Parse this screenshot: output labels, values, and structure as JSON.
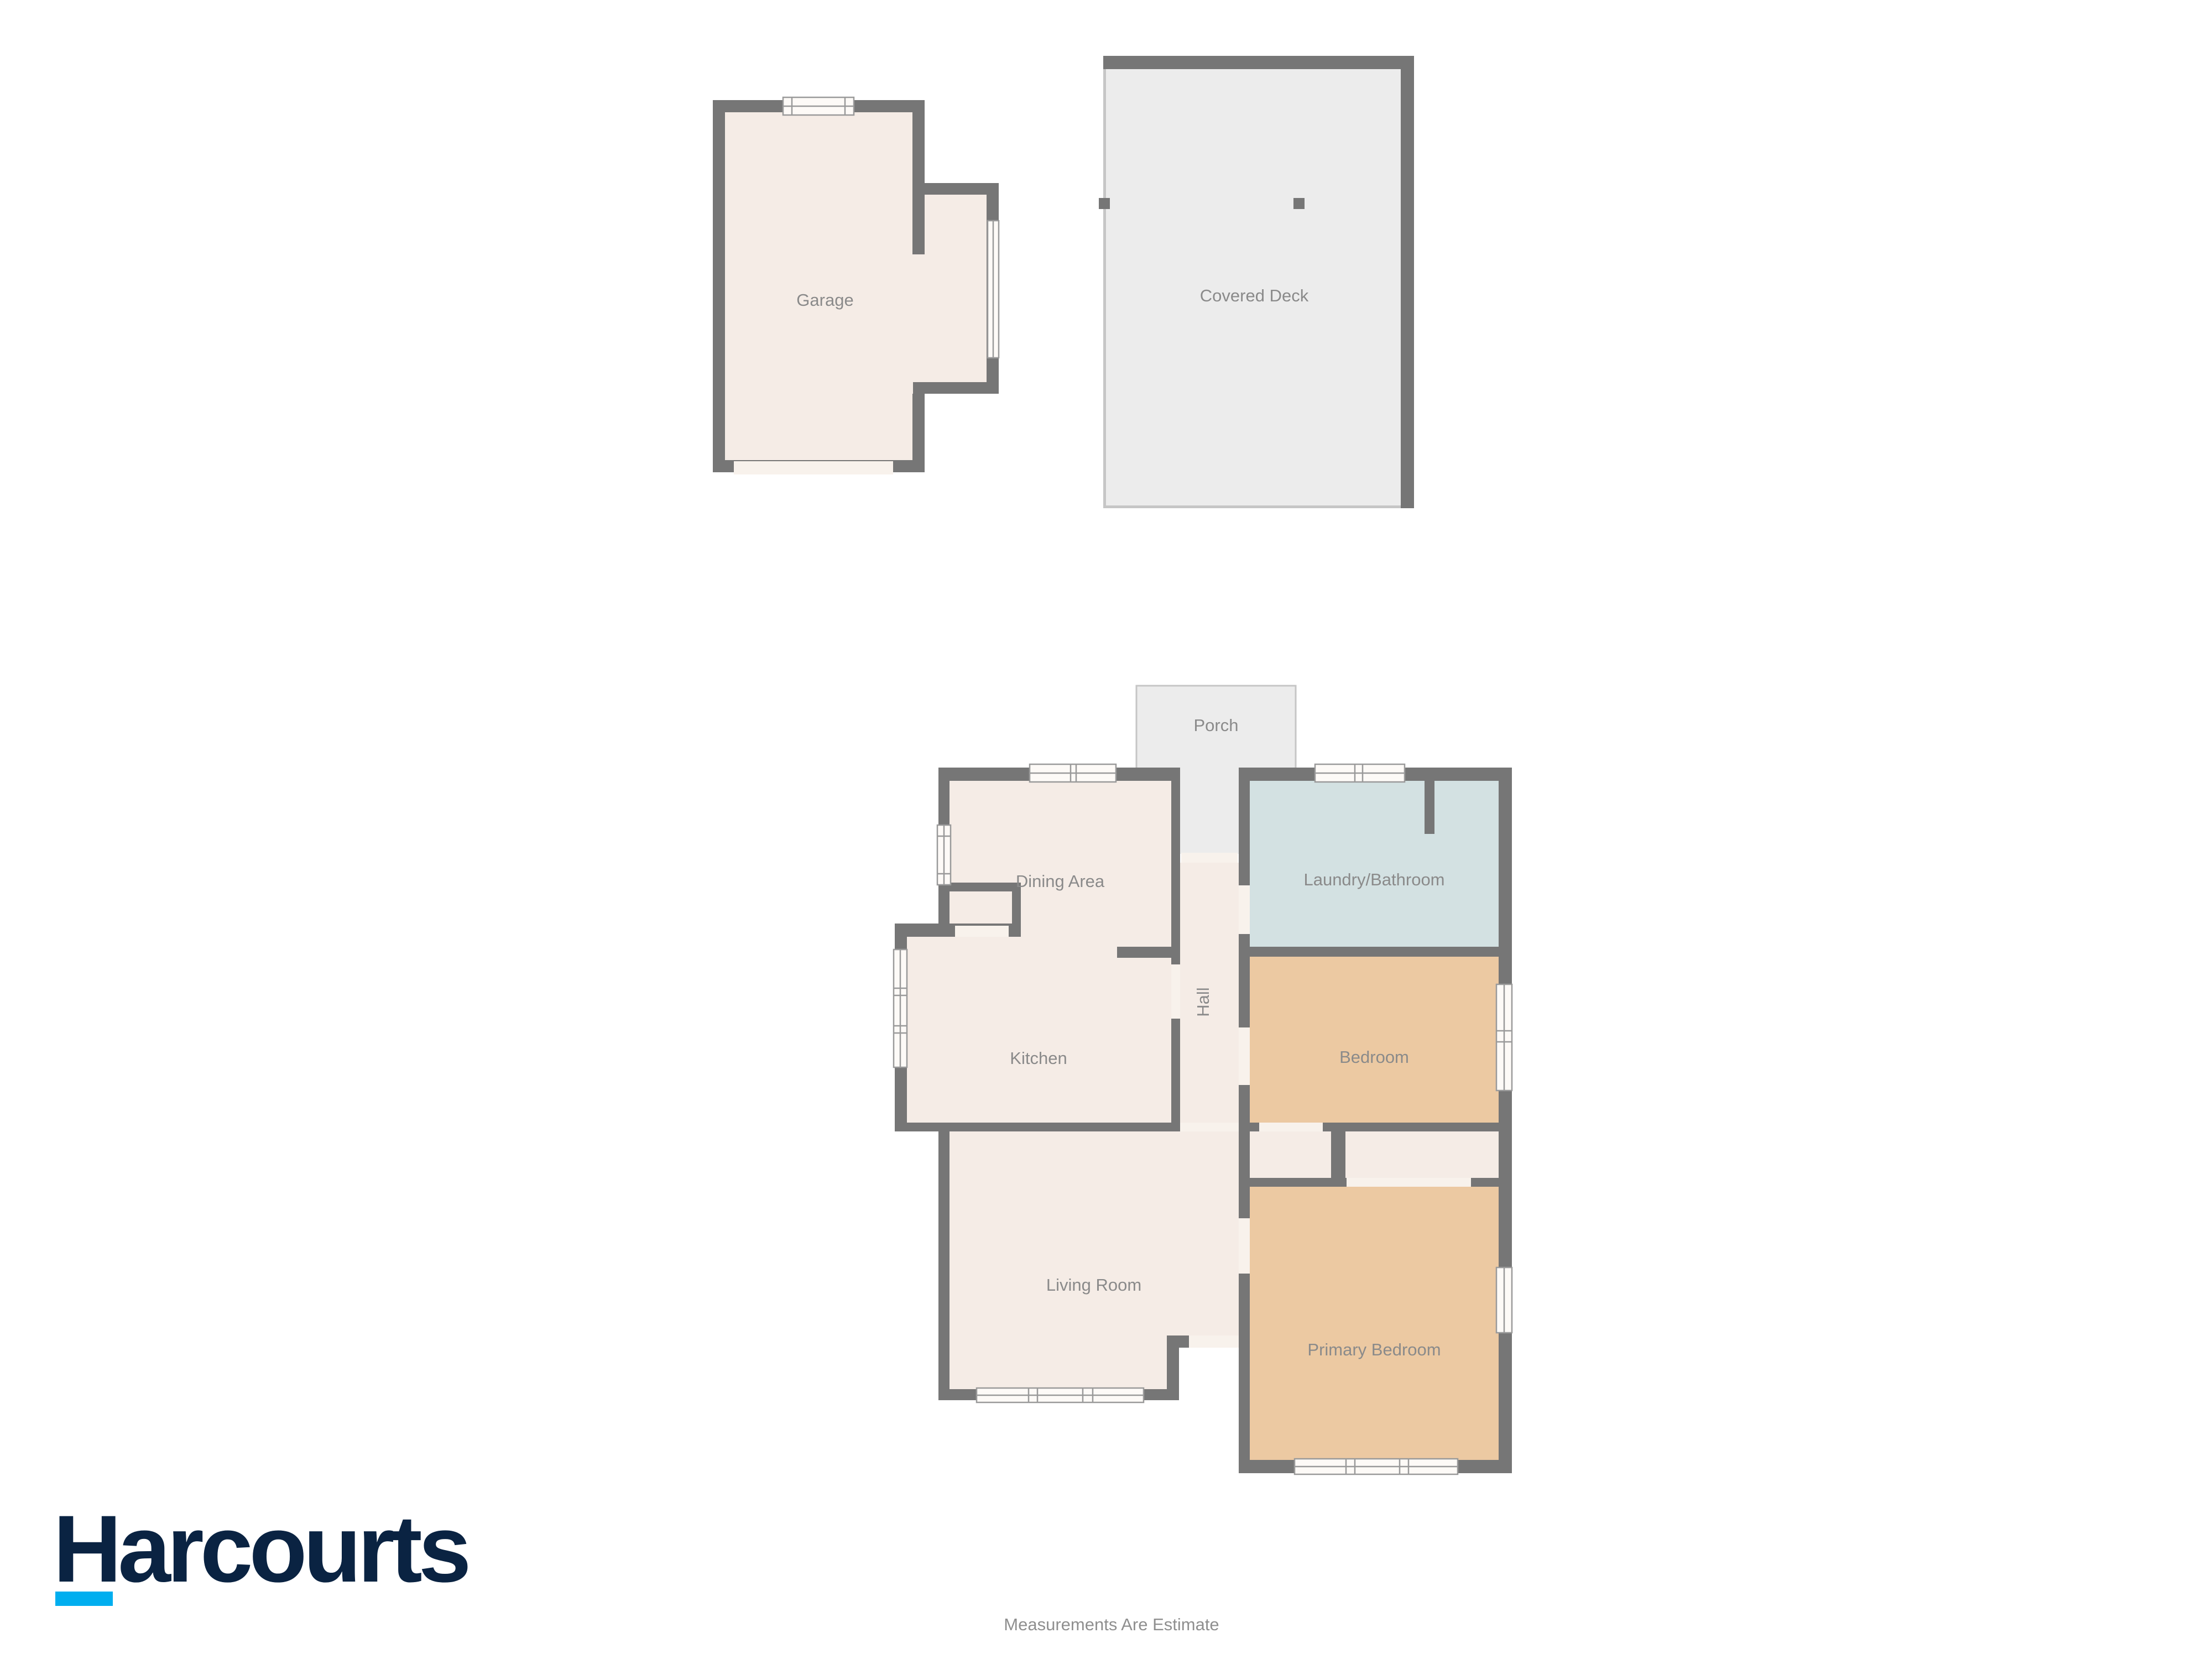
{
  "colors": {
    "wall": "#767676",
    "room_cream": "#f5ece6",
    "room_tan": "#ecc9a2",
    "room_blue": "#d3e1e2",
    "outdoor_gray": "#ececec",
    "outdoor_border": "#c6c6c6",
    "window_fill": "#fdfaf7",
    "window_frame": "#9a9a9a",
    "threshold": "#f8f2ec",
    "label_gray": "#8a8a8a",
    "logo_navy": "#0a2342",
    "logo_cyan": "#00aeef",
    "disclaimer_gray": "#8f8f8f"
  },
  "plan": {
    "garage": {
      "label": "Garage"
    },
    "covered_deck": {
      "label": "Covered Deck"
    },
    "porch": {
      "label": "Porch"
    },
    "dining": {
      "label": "Dining Area"
    },
    "laundry": {
      "label": "Laundry/Bathroom"
    },
    "hall": {
      "label": "Hall"
    },
    "kitchen": {
      "label": "Kitchen"
    },
    "bedroom": {
      "label": "Bedroom"
    },
    "living": {
      "label": "Living Room"
    },
    "primary": {
      "label": "Primary Bedroom"
    }
  },
  "branding": {
    "logo_text": "Harcourts"
  },
  "footer": {
    "disclaimer": "Measurements Are Estimate"
  }
}
